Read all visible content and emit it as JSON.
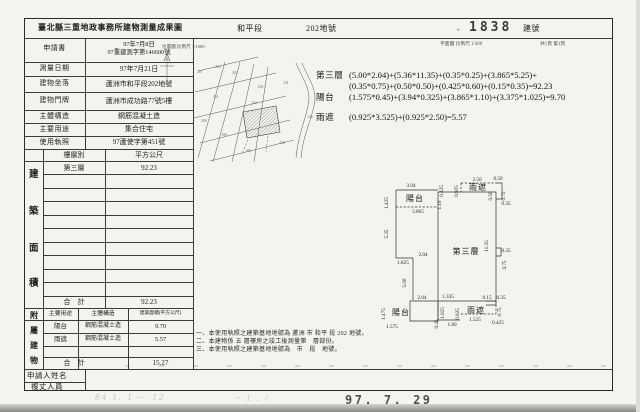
{
  "header": {
    "title": "臺北縣三重地政事務所建物測量成果圖",
    "section": "和平段",
    "lot": "202地號",
    "dash": "-",
    "building_no": "1838",
    "building_no_label": "建號",
    "location_scale": "位置圖 比例尺 1/1000",
    "plan_scale": "平面圖 比例尺 1/300",
    "page": "共1頁 第1頁"
  },
  "info_table": {
    "rows": [
      {
        "label": "申請書",
        "value": "97年7月8日\n97重建測字第146600號"
      },
      {
        "label": "測量日期",
        "value": "97年7月21日"
      },
      {
        "label": "建物坐落",
        "value": "蘆洲市和平段202地號"
      },
      {
        "label": "建物門牌",
        "value": "蘆洲市成功路77號5樓"
      },
      {
        "label": "主體構造",
        "value": "鋼筋混凝土造"
      },
      {
        "label": "主要用途",
        "value": "集合住宅"
      },
      {
        "label": "使用執照",
        "value": "97蘆使字第451號"
      }
    ]
  },
  "area_table": {
    "vertical_label": [
      "建",
      "築",
      "面",
      "積"
    ],
    "col_floor": "樓層別",
    "col_area": "平方公尺",
    "rows": [
      {
        "floor": "第三層",
        "area": "92.23"
      }
    ],
    "total_label": "合　計",
    "total": "92.23"
  },
  "annex_table": {
    "vertical_label": [
      "附",
      "屬",
      "建",
      "物"
    ],
    "col_use": "主要用途",
    "col_structure": "主體構造",
    "col_area": "建築面積(平方公尺)",
    "rows": [
      {
        "use": "陽台",
        "structure": "鋼筋混凝土造",
        "area": "9.70"
      },
      {
        "use": "雨遮",
        "structure": "鋼筋混凝土造",
        "area": "5.57"
      }
    ],
    "total_label": "合　計",
    "total": "15.27"
  },
  "formulas": [
    {
      "label": "第三層",
      "text": "(5.00*2.04)+(5.36*11.35)+(0.35*0.25)+(3.865*5.25)+\n(0.35*0.75)+(0.50*0.50)+(0.425*0.60)+(0.15*0.35)=92.23"
    },
    {
      "label": "陽台",
      "text": "(1.575*0.45)+(3.94*0.325)+(3.865*1.10)+(3.375*1.025)=9.70"
    },
    {
      "label": "雨遮",
      "text": "(0.925*3.525)+(0.925*2.50)=5.57"
    }
  ],
  "notes": [
    "一、本使用執照之建築基地地號為 蘆洲 市 和平 段 202 地號。",
    "二、本建物係 五 層樓房之竣工後測量第　層部份。",
    "三、本使用執照之建築基地地號為　市　段　地號。"
  ],
  "footer": {
    "applicant_label": "申請人姓名",
    "surveyor_label": "複丈人員",
    "date_stamp": "97. 7. 29",
    "pencil_left": "84 1. 1 — 12",
    "pencil_mid": "~ 1 . /"
  },
  "floor_plan": {
    "labels": [
      {
        "t": "3.94",
        "x": 43,
        "y": 39
      },
      {
        "t": "1.425",
        "x": 20,
        "y": 55,
        "v": 1
      },
      {
        "t": "陽台",
        "x": 47,
        "y": 53,
        "big": 1
      },
      {
        "t": "0.325",
        "x": 75,
        "y": 43,
        "v": 1
      },
      {
        "t": "0.925",
        "x": 90,
        "y": 43,
        "v": 1
      },
      {
        "t": "2.50",
        "x": 109,
        "y": 33
      },
      {
        "t": "0.50",
        "x": 130,
        "y": 32
      },
      {
        "t": "雨遮",
        "x": 110,
        "y": 42,
        "big": 1
      },
      {
        "t": "0.50",
        "x": 124,
        "y": 48,
        "v": 1
      },
      {
        "t": "0.75",
        "x": 137,
        "y": 48,
        "v": 1
      },
      {
        "t": "0.35",
        "x": 138,
        "y": 57
      },
      {
        "t": "1.10",
        "x": 73,
        "y": 57,
        "v": 1
      },
      {
        "t": "3.865",
        "x": 50,
        "y": 65
      },
      {
        "t": "5.25",
        "x": 20,
        "y": 86,
        "v": 1
      },
      {
        "t": "11.35",
        "x": 120,
        "y": 98,
        "v": 1
      },
      {
        "t": "第三層",
        "x": 98,
        "y": 106,
        "big": 1
      },
      {
        "t": "0.35",
        "x": 138,
        "y": 104
      },
      {
        "t": "0.75",
        "x": 138,
        "y": 117,
        "v": 1
      },
      {
        "t": "2.04",
        "x": 55,
        "y": 108
      },
      {
        "t": "1.825",
        "x": 35,
        "y": 116
      },
      {
        "t": "5.00",
        "x": 38,
        "y": 135,
        "v": 1
      },
      {
        "t": "2.04",
        "x": 54,
        "y": 151
      },
      {
        "t": "1.335",
        "x": 80,
        "y": 150
      },
      {
        "t": "0.15",
        "x": 119,
        "y": 151
      },
      {
        "t": "0.35",
        "x": 133,
        "y": 151
      },
      {
        "t": "1.475",
        "x": 17,
        "y": 166,
        "v": 1
      },
      {
        "t": "陽台",
        "x": 33,
        "y": 167,
        "big": 1
      },
      {
        "t": "1.025",
        "x": 76,
        "y": 165,
        "v": 1
      },
      {
        "t": "0.925",
        "x": 91,
        "y": 166,
        "v": 1
      },
      {
        "t": "雨遮",
        "x": 108,
        "y": 165,
        "big": 1
      },
      {
        "t": "0.75",
        "x": 133,
        "y": 164,
        "v": 1
      },
      {
        "t": "0.45",
        "x": 70,
        "y": 176,
        "v": 1
      },
      {
        "t": "1.575",
        "x": 24,
        "y": 180
      },
      {
        "t": "1.80",
        "x": 84,
        "y": 178
      },
      {
        "t": "1.525",
        "x": 107,
        "y": 173
      },
      {
        "t": "0.425",
        "x": 130,
        "y": 176
      }
    ]
  },
  "map": {
    "lots": [
      {
        "t": "207",
        "x": 50,
        "y": 33
      },
      {
        "t": "204",
        "x": 68,
        "y": 28
      },
      {
        "t": "203",
        "x": 85,
        "y": 34
      },
      {
        "t": "203-1",
        "x": 112,
        "y": 48
      },
      {
        "t": "202",
        "x": 104,
        "y": 64
      },
      {
        "t": "201",
        "x": 66,
        "y": 58
      },
      {
        "t": "200",
        "x": 54,
        "y": 82
      },
      {
        "t": "198",
        "x": 74,
        "y": 96
      },
      {
        "t": "199",
        "x": 98,
        "y": 112
      },
      {
        "t": "241",
        "x": 136,
        "y": 44
      },
      {
        "t": "142",
        "x": 160,
        "y": 78
      },
      {
        "t": "240",
        "x": 132,
        "y": 104
      }
    ]
  }
}
